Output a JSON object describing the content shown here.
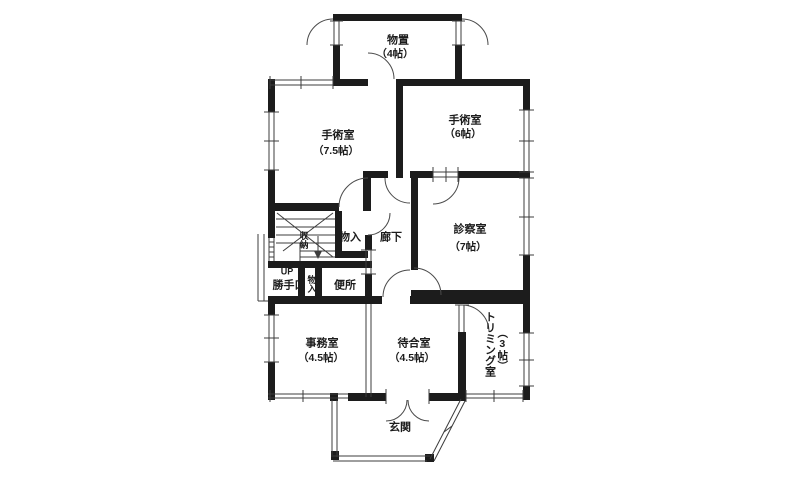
{
  "floor_plan": {
    "rooms": {
      "storage": {
        "name": "物置",
        "size": "（4帖）"
      },
      "operating_room_large": {
        "name": "手術室",
        "size": "（7.5帖）"
      },
      "operating_room_small": {
        "name": "手術室",
        "size": "（6帖）"
      },
      "exam_room": {
        "name": "診察室",
        "size": "（7帖）"
      },
      "closet_center": {
        "name": "物入"
      },
      "hallway": {
        "name": "廊下"
      },
      "stair_storage": {
        "name": "収納"
      },
      "stairs": {
        "up_label": "UP"
      },
      "back_door": {
        "name": "勝手口"
      },
      "closet_small": {
        "name": "物入"
      },
      "toilet": {
        "name": "便所"
      },
      "office": {
        "name": "事務室",
        "size": "（4.5帖）"
      },
      "waiting_room": {
        "name": "待合室",
        "size": "（4.5帖）"
      },
      "trimming_room": {
        "name": "トリミング室",
        "size": "（3帖）"
      },
      "entrance": {
        "name": "玄関"
      }
    },
    "colors": {
      "wall": "#1c1c1c",
      "thin_line": "#3c3c3c",
      "door_arc": "#4a4a4a",
      "background": "#ffffff",
      "text": "#1c1c1c"
    }
  }
}
